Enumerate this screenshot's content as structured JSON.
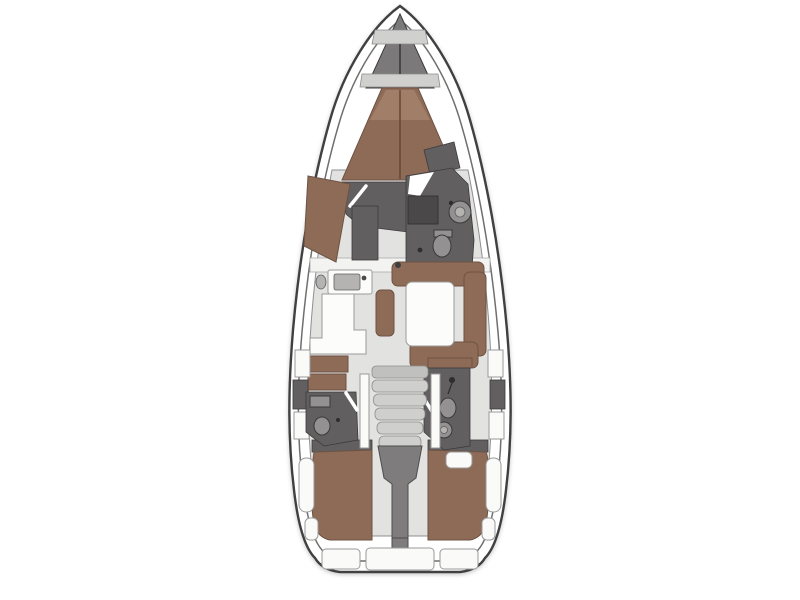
{
  "page": {
    "background": "#ffffff",
    "content_type": "yacht-interior-deck-plan",
    "view": "top-down floor plan, bow pointing up, no text labels"
  },
  "colors": {
    "page-bg": "#ffffff",
    "deck-white": "#ffffff",
    "hull-line": "#3f3f3f",
    "inner-line": "#6f6f6f",
    "floor": "#e2e2e0",
    "floor-edge": "#8f8f8f",
    "berth": "#8d6b57",
    "berth-light": "#a07e67",
    "berth-edge": "#6e5243",
    "berth-split": "#5f4536",
    "dark-furniture": "#615f60",
    "dark-furniture-deep": "#4a4849",
    "fixture": "#939192",
    "fixture-edge": "#3a3a3a",
    "counter": "#fcfcfb",
    "counter-edge": "#9b9b9b",
    "sink-basin": "#b5b3b2",
    "tread": "#cfcfcd",
    "tread-edge": "#8e8e8c",
    "white-panel": "#fafaf8",
    "engine": "#7e7c7d",
    "locker-band": "#d0d0ce",
    "anchor-locker": "#7b797a",
    "bulkhead": "#f3f3f1"
  },
  "vessel": {
    "hull": {
      "style": "monohull sailing yacht",
      "bow": "top",
      "stern": "bottom"
    },
    "areas": [
      {
        "id": "anchor-locker",
        "name": "anchor locker / forepeak",
        "position": "bow"
      },
      {
        "id": "forward-cabin",
        "name": "forward owner cabin with V-berth (brown mattress, split centre)",
        "position": "forward"
      },
      {
        "id": "forward-cabin-sofa",
        "name": "chaise / sofa along port hull side",
        "position": "forward port"
      },
      {
        "id": "forward-head",
        "name": "en-suite head with basin and toilet",
        "position": "forward starboard"
      },
      {
        "id": "wardrobe",
        "name": "wardrobe locker beside corridor",
        "position": "forward of saloon"
      },
      {
        "id": "galley",
        "name": "L-shaped galley with sink unit",
        "position": "midship port"
      },
      {
        "id": "chart-seat",
        "name": "brown bench / chart seat",
        "position": "midship port aft of galley"
      },
      {
        "id": "dinette",
        "name": "U-shaped dinette sofa with white table and pouf",
        "position": "midship starboard"
      },
      {
        "id": "mast-step",
        "name": "mast foot dot",
        "position": "centreline at saloon bulkhead"
      },
      {
        "id": "port-aft-head",
        "name": "port aft head with basin and toilet",
        "position": "aft port"
      },
      {
        "id": "starboard-aft-head",
        "name": "starboard aft head with shower, toilet, basin",
        "position": "aft starboard"
      },
      {
        "id": "companionway",
        "name": "companionway steps (5 treads)",
        "position": "centre aft"
      },
      {
        "id": "engine-compartment",
        "name": "engine compartment wedge under steps",
        "position": "centre aft"
      },
      {
        "id": "port-aft-cabin",
        "name": "port aft double cabin (brown berth)",
        "position": "stern port"
      },
      {
        "id": "starboard-aft-cabin",
        "name": "starboard aft double cabin (brown berth)",
        "position": "stern starboard"
      },
      {
        "id": "side-lockers",
        "name": "alternating white / grey side-deck lockers",
        "position": "both rails amidships-aft"
      },
      {
        "id": "cockpit-benches",
        "name": "white rounded side benches",
        "position": "aft along both hulls"
      },
      {
        "id": "transom",
        "name": "transom with segmented swim platform",
        "position": "stern"
      }
    ],
    "counts": {
      "cabins": 3,
      "heads": 3,
      "berths_brown": 3
    }
  }
}
